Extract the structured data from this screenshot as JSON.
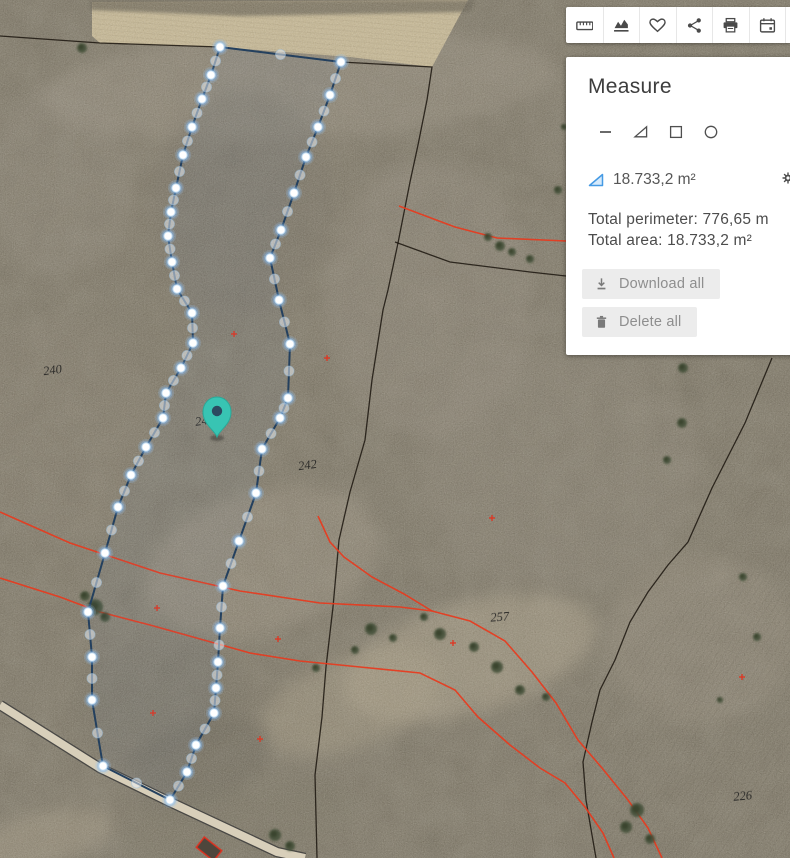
{
  "toolbar": {
    "icons": [
      {
        "name": "ruler-icon"
      },
      {
        "name": "elevation-chart-icon"
      },
      {
        "name": "heart-icon"
      },
      {
        "name": "share-icon"
      },
      {
        "name": "printer-icon"
      },
      {
        "name": "calendar-icon"
      }
    ]
  },
  "panel": {
    "title": "Measure",
    "tools": [
      {
        "name": "line-tool-icon"
      },
      {
        "name": "triangle-area-tool-icon"
      },
      {
        "name": "rectangle-tool-icon"
      },
      {
        "name": "circle-tool-icon"
      }
    ],
    "measurement": {
      "icon": "area-triangle-icon",
      "value": "18.733,2 m²"
    },
    "settings_icon": "gear-icon",
    "menu_icon": "kebab-menu-icon",
    "totals": {
      "perimeter_label": "Total perimeter:",
      "perimeter_value": "776,65 m",
      "area_label": "Total area:",
      "area_value": "18.733,2 m²"
    },
    "buttons": {
      "download": {
        "icon": "download-icon",
        "label": "Download all"
      },
      "delete": {
        "icon": "trash-icon",
        "label": "Delete all"
      }
    }
  },
  "map": {
    "colors": {
      "terrain_base": "#87806f",
      "field": "#cdbd96",
      "hedge": "#5e5949",
      "road_fill": "#d8cfba",
      "road_edge": "#3a3a3a",
      "polygon_stroke": "#24405e",
      "vertex_glow": "rgba(130,185,240,0.38)",
      "vertex_core": "#ffffff",
      "pin": "#38c4b3",
      "pin_center": "#2c4a60",
      "red_line": "#e8391d",
      "black_line": "#1b150e",
      "tree": "#46523a",
      "label": "#1c1c1c",
      "marker": "#e03420",
      "building_fill": "#4e463c",
      "building_stroke": "#e0301e"
    },
    "parcel_labels": [
      {
        "text": "240",
        "x": 53,
        "y": 374,
        "rot": -8
      },
      {
        "text": "24",
        "x": 202,
        "y": 425,
        "rot": -8
      },
      {
        "text": "242",
        "x": 308,
        "y": 469,
        "rot": -8
      },
      {
        "text": "257",
        "x": 500,
        "y": 621,
        "rot": -4
      },
      {
        "text": "226",
        "x": 743,
        "y": 800,
        "rot": -5
      }
    ],
    "measure_polygon": {
      "ring": [
        [
          220,
          47
        ],
        [
          211,
          75
        ],
        [
          202,
          99
        ],
        [
          192,
          127
        ],
        [
          183,
          155
        ],
        [
          176,
          188
        ],
        [
          171,
          212
        ],
        [
          168,
          236
        ],
        [
          172,
          262
        ],
        [
          177,
          289
        ],
        [
          192,
          313
        ],
        [
          193,
          343
        ],
        [
          181,
          368
        ],
        [
          166,
          393
        ],
        [
          163,
          418
        ],
        [
          146,
          447
        ],
        [
          131,
          475
        ],
        [
          118,
          507
        ],
        [
          105,
          553
        ],
        [
          88,
          612
        ],
        [
          92,
          657
        ],
        [
          92,
          700
        ],
        [
          103,
          766
        ],
        [
          170,
          800
        ],
        [
          187,
          772
        ],
        [
          196,
          745
        ],
        [
          214,
          713
        ],
        [
          216,
          688
        ],
        [
          218,
          662
        ],
        [
          220,
          628
        ],
        [
          223,
          586
        ],
        [
          239,
          541
        ],
        [
          256,
          493
        ],
        [
          262,
          449
        ],
        [
          280,
          418
        ],
        [
          288,
          398
        ],
        [
          290,
          344
        ],
        [
          279,
          300
        ],
        [
          270,
          258
        ],
        [
          281,
          230
        ],
        [
          294,
          193
        ],
        [
          306,
          157
        ],
        [
          318,
          127
        ],
        [
          330,
          95
        ],
        [
          341,
          62
        ]
      ]
    },
    "pin": {
      "x": 217,
      "y": 437
    },
    "black_lines": [
      [
        [
          0,
          36
        ],
        [
          100,
          43
        ],
        [
          220,
          47
        ],
        [
          341,
          62
        ],
        [
          432,
          67
        ],
        [
          427,
          100
        ],
        [
          418,
          145
        ],
        [
          410,
          182
        ],
        [
          398,
          243
        ],
        [
          388,
          290
        ],
        [
          383,
          310
        ],
        [
          372,
          380
        ],
        [
          365,
          440
        ],
        [
          350,
          492
        ],
        [
          339,
          540
        ],
        [
          333,
          607
        ],
        [
          326,
          667
        ],
        [
          322,
          717
        ],
        [
          315,
          775
        ],
        [
          317,
          858
        ]
      ],
      [
        [
          772,
          358
        ],
        [
          745,
          423
        ],
        [
          712,
          488
        ],
        [
          688,
          542
        ],
        [
          668,
          565
        ],
        [
          648,
          592
        ],
        [
          630,
          622
        ],
        [
          615,
          660
        ],
        [
          600,
          690
        ],
        [
          592,
          722
        ],
        [
          583,
          762
        ],
        [
          586,
          800
        ],
        [
          592,
          835
        ],
        [
          596,
          858
        ]
      ],
      [
        [
          395,
          242
        ],
        [
          450,
          262
        ],
        [
          530,
          272
        ],
        [
          566,
          276
        ]
      ]
    ],
    "red_lines": [
      [
        [
          399,
          206
        ],
        [
          455,
          227
        ],
        [
          497,
          238
        ],
        [
          566,
          241
        ]
      ],
      [
        [
          0,
          512
        ],
        [
          70,
          543
        ],
        [
          160,
          573
        ],
        [
          240,
          591
        ],
        [
          320,
          603
        ],
        [
          400,
          607
        ],
        [
          432,
          611
        ],
        [
          470,
          621
        ],
        [
          505,
          641
        ],
        [
          532,
          672
        ],
        [
          556,
          703
        ],
        [
          578,
          740
        ],
        [
          602,
          768
        ],
        [
          628,
          800
        ],
        [
          648,
          828
        ],
        [
          662,
          858
        ]
      ],
      [
        [
          318,
          516
        ],
        [
          330,
          542
        ],
        [
          344,
          557
        ],
        [
          372,
          577
        ],
        [
          404,
          594
        ],
        [
          432,
          611
        ]
      ],
      [
        [
          0,
          578
        ],
        [
          60,
          597
        ],
        [
          100,
          612
        ],
        [
          150,
          625
        ],
        [
          193,
          637
        ],
        [
          250,
          653
        ],
        [
          300,
          661
        ],
        [
          350,
          666
        ],
        [
          420,
          673
        ],
        [
          455,
          690
        ],
        [
          478,
          717
        ],
        [
          510,
          745
        ],
        [
          540,
          768
        ],
        [
          565,
          783
        ],
        [
          585,
          807
        ],
        [
          603,
          833
        ],
        [
          614,
          858
        ]
      ]
    ],
    "red_markers": [
      [
        234,
        334
      ],
      [
        327,
        358
      ],
      [
        492,
        518
      ],
      [
        157,
        608
      ],
      [
        278,
        639
      ],
      [
        453,
        643
      ],
      [
        742,
        677
      ],
      [
        153,
        713
      ],
      [
        260,
        739
      ]
    ],
    "roads": [
      {
        "path": [
          [
            0,
            705
          ],
          [
            100,
            768
          ],
          [
            170,
            802
          ],
          [
            277,
            852
          ],
          [
            305,
            858
          ]
        ],
        "width": 8
      }
    ],
    "field": {
      "points": [
        [
          92,
          2
        ],
        [
          468,
          0
        ],
        [
          432,
          67
        ],
        [
          350,
          57
        ],
        [
          220,
          47
        ],
        [
          100,
          43
        ],
        [
          92,
          36
        ]
      ]
    },
    "hedge": {
      "points": [
        [
          90,
          0
        ],
        [
          475,
          0
        ],
        [
          470,
          12
        ],
        [
          240,
          16
        ],
        [
          90,
          10
        ]
      ]
    },
    "striped_fields": [
      {
        "points": [
          [
            600,
            858
          ],
          [
            560,
            712
          ],
          [
            680,
            600
          ],
          [
            790,
            560
          ],
          [
            790,
            858
          ]
        ],
        "pattern": "stripesA",
        "o": 0.5
      },
      {
        "points": [
          [
            690,
            380
          ],
          [
            790,
            355
          ],
          [
            790,
            560
          ],
          [
            700,
            500
          ]
        ],
        "pattern": "stripesA",
        "o": 0.35
      }
    ],
    "patches": [
      {
        "x": 300,
        "y": 85,
        "rx": 260,
        "ry": 55,
        "rot": -3,
        "c": "#9a9181",
        "o": 0.45
      },
      {
        "x": 240,
        "y": 205,
        "rx": 90,
        "ry": 115,
        "rot": 10,
        "c": "#6e675b",
        "o": 0.4
      },
      {
        "x": 150,
        "y": 305,
        "rx": 60,
        "ry": 80,
        "rot": 0,
        "c": "#77705f",
        "o": 0.35
      },
      {
        "x": 58,
        "y": 430,
        "rx": 95,
        "ry": 115,
        "rot": 0,
        "c": "#837a6a",
        "o": 0.35
      },
      {
        "x": 430,
        "y": 300,
        "rx": 105,
        "ry": 140,
        "rot": 0,
        "c": "#8f8678",
        "o": 0.4
      },
      {
        "x": 560,
        "y": 470,
        "rx": 140,
        "ry": 120,
        "rot": 0,
        "c": "#8a8273",
        "o": 0.35
      },
      {
        "x": 262,
        "y": 562,
        "rx": 120,
        "ry": 70,
        "rot": -15,
        "c": "#9c9280",
        "o": 0.45
      },
      {
        "x": 470,
        "y": 658,
        "rx": 130,
        "ry": 55,
        "rot": -16,
        "c": "#b2a68c",
        "o": 0.5
      },
      {
        "x": 352,
        "y": 702,
        "rx": 95,
        "ry": 45,
        "rot": -20,
        "c": "#a89c82",
        "o": 0.45
      },
      {
        "x": 160,
        "y": 700,
        "rx": 90,
        "ry": 60,
        "rot": -15,
        "c": "#6b6557",
        "o": 0.4
      },
      {
        "x": 200,
        "y": 762,
        "rx": 72,
        "ry": 45,
        "rot": -20,
        "c": "#5f5a4e",
        "o": 0.45
      },
      {
        "x": 700,
        "y": 640,
        "rx": 95,
        "ry": 85,
        "rot": 0,
        "c": "#978d7b",
        "o": 0.35
      },
      {
        "x": 742,
        "y": 205,
        "rx": 85,
        "ry": 120,
        "rot": 0,
        "c": "#8e8677",
        "o": 0.35
      },
      {
        "x": 60,
        "y": 180,
        "rx": 75,
        "ry": 95,
        "rot": 0,
        "c": "#90887a",
        "o": 0.3
      },
      {
        "x": 620,
        "y": 322,
        "rx": 85,
        "ry": 52,
        "rot": 0,
        "c": "#7d7668",
        "o": 0.3
      },
      {
        "x": 240,
        "y": 822,
        "rx": 120,
        "ry": 40,
        "rot": -10,
        "c": "#6f6a58",
        "o": 0.4
      },
      {
        "x": 40,
        "y": 840,
        "rx": 75,
        "ry": 26,
        "rot": -15,
        "c": "#a99d85",
        "o": 0.45
      },
      {
        "x": 640,
        "y": 120,
        "rx": 120,
        "ry": 70,
        "rot": -5,
        "c": "#837b6c",
        "o": 0.35
      }
    ],
    "trees": [
      [
        95,
        607,
        8
      ],
      [
        85,
        596,
        5
      ],
      [
        105,
        617,
        5
      ],
      [
        371,
        629,
        6
      ],
      [
        440,
        634,
        6
      ],
      [
        474,
        647,
        5
      ],
      [
        497,
        667,
        6
      ],
      [
        520,
        690,
        5
      ],
      [
        546,
        697,
        4
      ],
      [
        683,
        368,
        5
      ],
      [
        682,
        423,
        5
      ],
      [
        667,
        460,
        4
      ],
      [
        637,
        810,
        7
      ],
      [
        626,
        827,
        6
      ],
      [
        650,
        839,
        5
      ],
      [
        275,
        835,
        6
      ],
      [
        290,
        846,
        5
      ],
      [
        558,
        190,
        4
      ],
      [
        500,
        246,
        5
      ],
      [
        512,
        252,
        4
      ],
      [
        530,
        259,
        4
      ],
      [
        488,
        237,
        4
      ],
      [
        82,
        48,
        5
      ],
      [
        564,
        127,
        3
      ],
      [
        743,
        577,
        4
      ],
      [
        757,
        637,
        4
      ],
      [
        720,
        700,
        3
      ],
      [
        424,
        617,
        4
      ],
      [
        393,
        638,
        4
      ],
      [
        355,
        650,
        4
      ],
      [
        316,
        668,
        4
      ]
    ],
    "building": {
      "x": 209,
      "y": 849,
      "w": 22,
      "h": 13,
      "rot": 38
    }
  }
}
